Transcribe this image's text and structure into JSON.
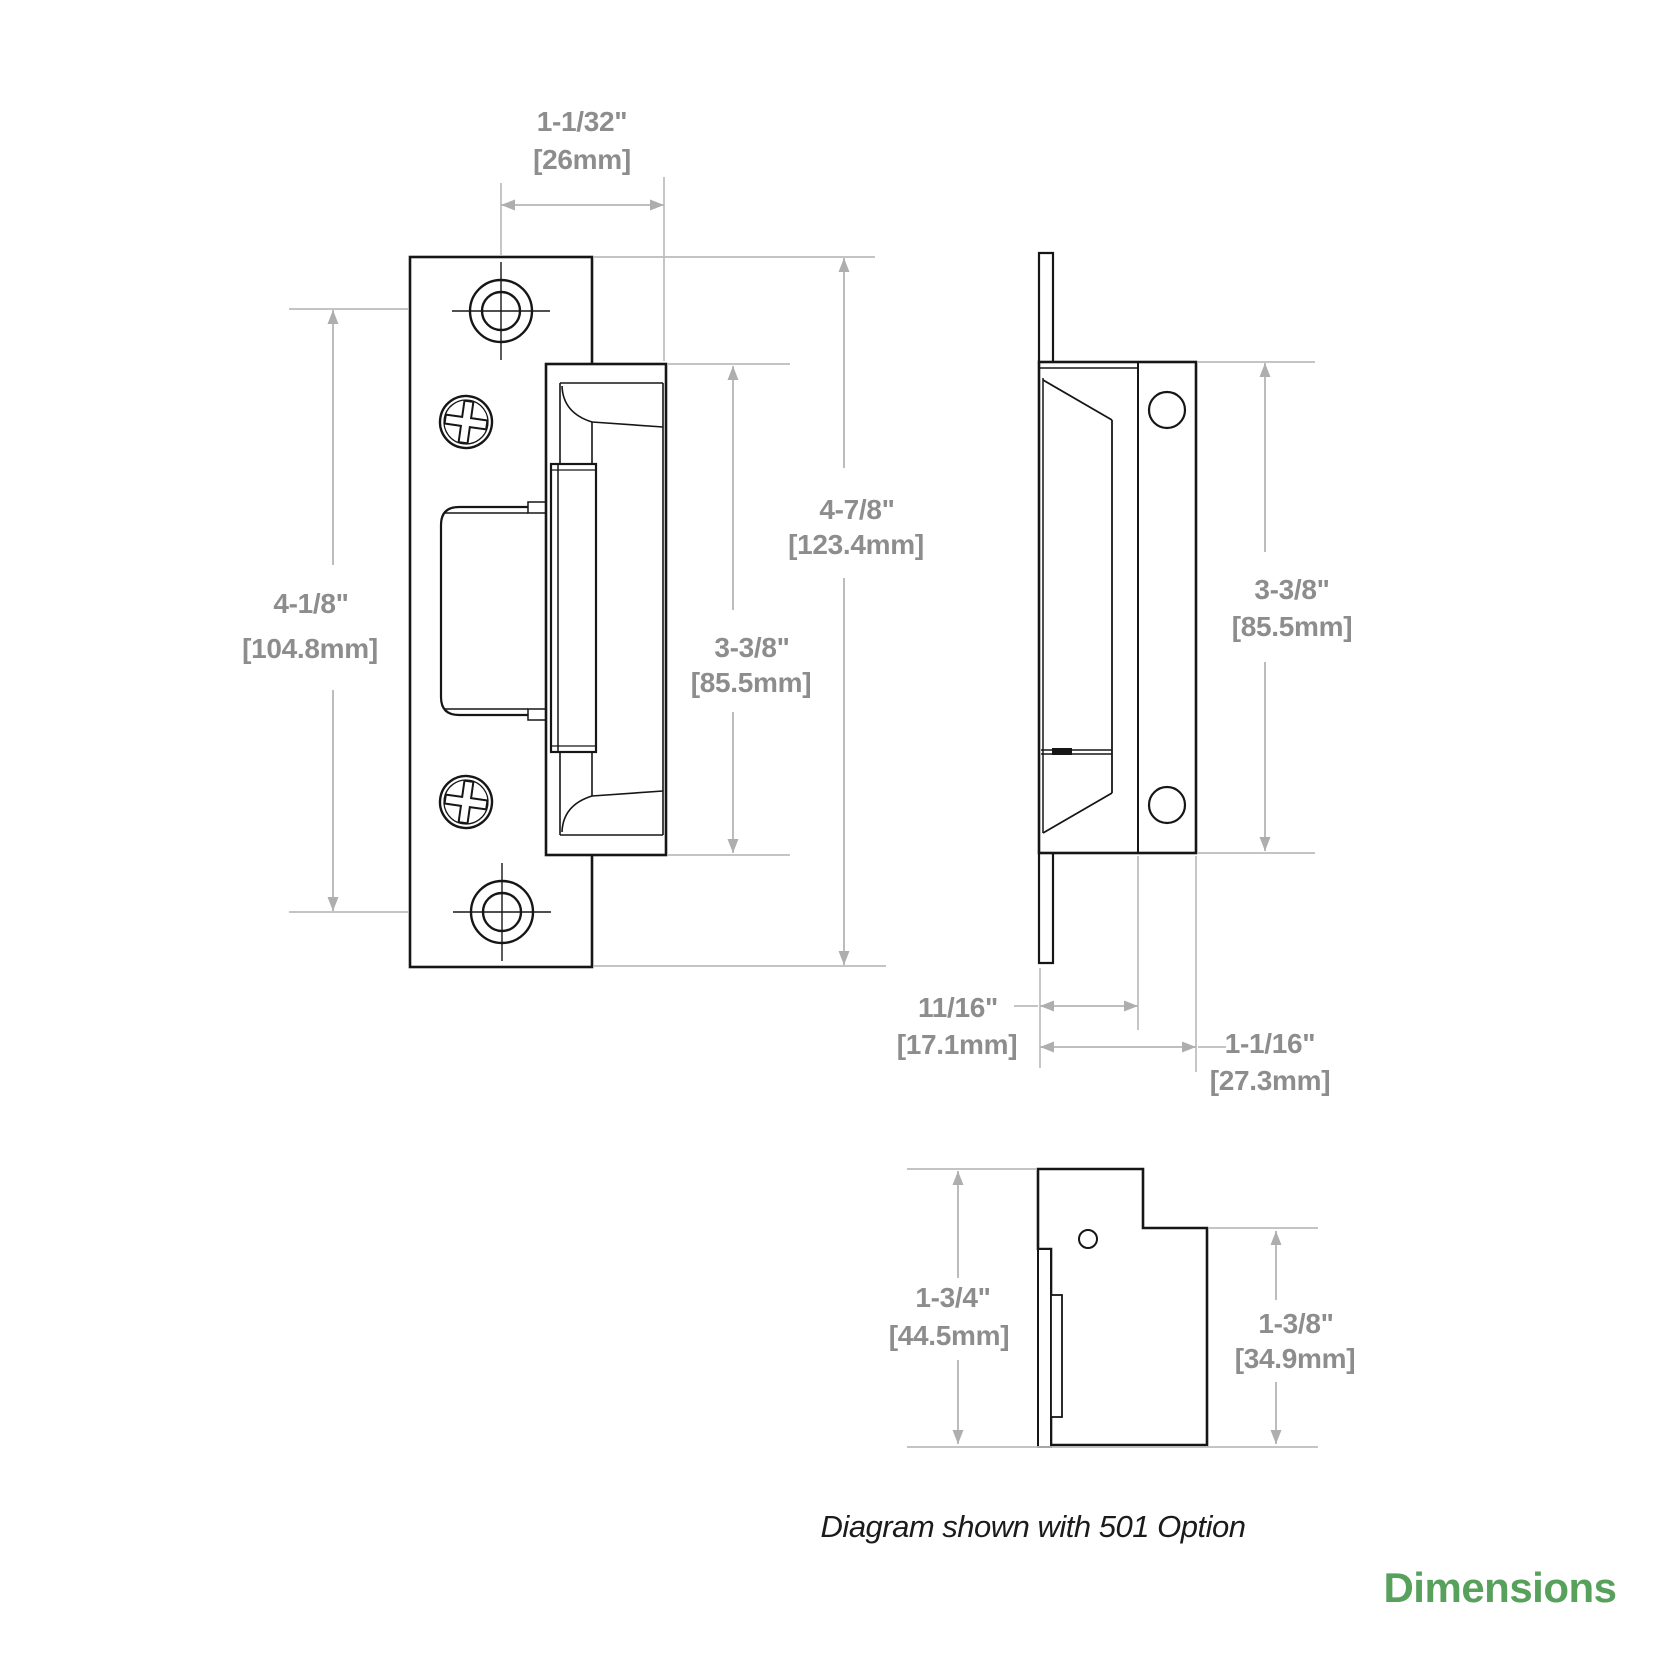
{
  "diagram": {
    "caption": "Diagram shown with 501 Option",
    "footer_label": "Dimensions",
    "colors": {
      "outline": "#161616",
      "dimension_line": "#b5b5b5",
      "dimension_text": "#8d8d8d",
      "accent_green": "#57a15c",
      "background": "#ffffff"
    },
    "dims": {
      "front_screw_to_edge": {
        "in": "1-1/32\"",
        "mm": "[26mm]"
      },
      "front_screw_spacing": {
        "in": "4-1/8\"",
        "mm": "[104.8mm]"
      },
      "front_total_height": {
        "in": "4-7/8\"",
        "mm": "[123.4mm]"
      },
      "front_body_height": {
        "in": "3-3/8\"",
        "mm": "[85.5mm]"
      },
      "side_body_height": {
        "in": "3-3/8\"",
        "mm": "[85.5mm]"
      },
      "side_depth_inner": {
        "in": "11/16\"",
        "mm": "[17.1mm]"
      },
      "side_depth_total": {
        "in": "1-1/16\"",
        "mm": "[27.3mm]"
      },
      "bottom_total_height": {
        "in": "1-3/4\"",
        "mm": "[44.5mm]"
      },
      "bottom_body_height": {
        "in": "1-3/8\"",
        "mm": "[34.9mm]"
      }
    }
  }
}
